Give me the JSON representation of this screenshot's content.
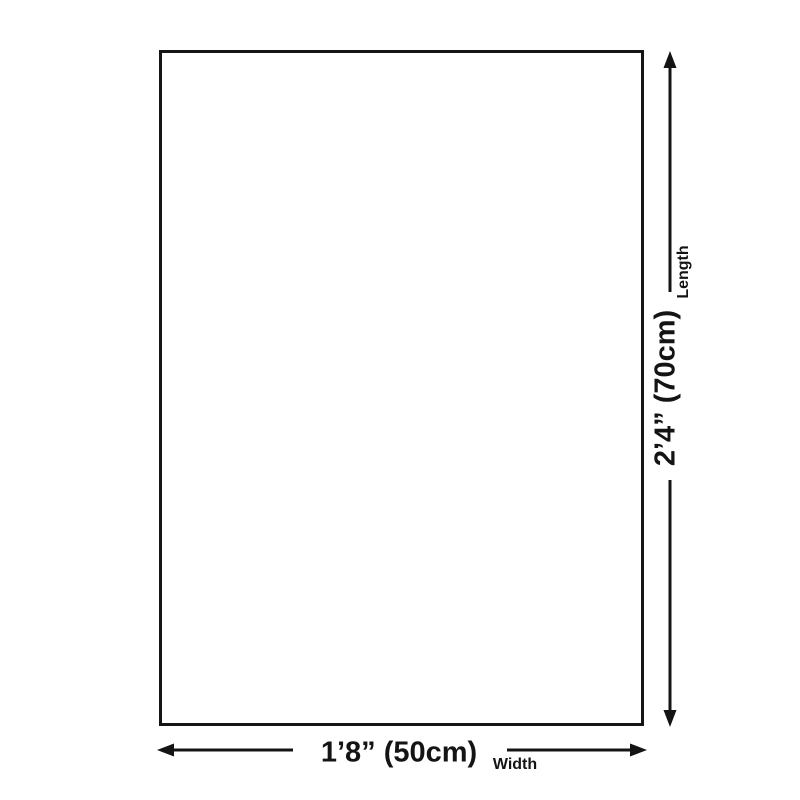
{
  "diagram": {
    "title": "product-size-diagram",
    "rectangle": {
      "fill": "#ffffff",
      "border_color": "#151515"
    },
    "length_dimension": {
      "value": "2’4” (70cm)",
      "label": "Length"
    },
    "width_dimension": {
      "value": "1’8” (50cm)",
      "label": "Width"
    },
    "colors": {
      "line": "#141414",
      "background": "#ffffff"
    }
  }
}
